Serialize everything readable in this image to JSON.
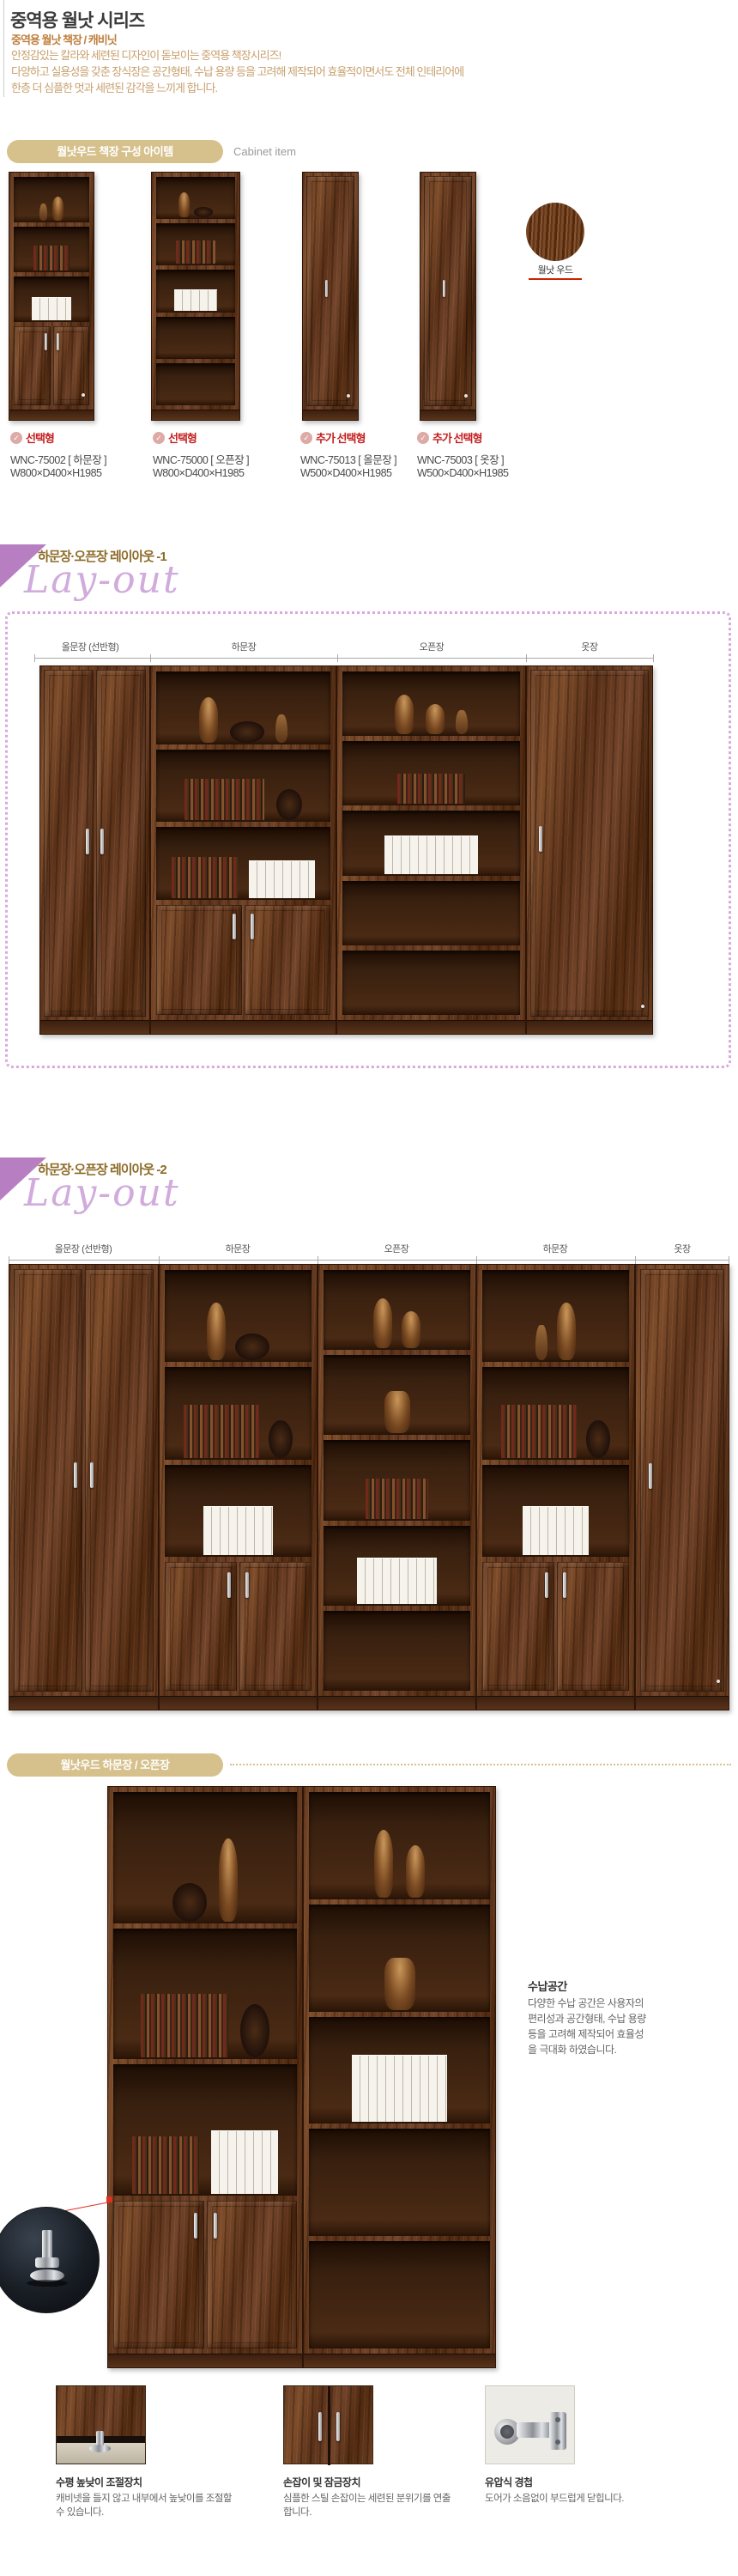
{
  "colors": {
    "accent_tan": "#d6c18c",
    "accent_purple": "#b77fc1",
    "script_purple": "#d0abdc",
    "badge_red": "#c42020",
    "section_title_brown": "#8d6b28",
    "subtitle_orange": "#bf7f3d",
    "desc_tan": "#c8a06e",
    "wood_brown": "#6b3f20",
    "marker_red": "#e03020"
  },
  "header": {
    "title": "중역용 월낫 시리즈",
    "subtitle": "중역용 월낫 책장 / 캐비닛",
    "desc_lines": [
      "안정감있는 칼라와 세련된 디자인이 돋보이는 중역용 책장시리즈!",
      "다양하고 실용성을 갖춘 장식장은 공간형태, 수납 용량 등을 고려해 제작되어 효율적이면서도 전체 인테리어에",
      "한층 더 심플한 멋과 세련된 감각을 느끼게 합니다."
    ]
  },
  "cabinet_items": {
    "banner": "월낫우드 책장 구성 아이템",
    "banner_en": "Cabinet item",
    "wood_swatch_label": "월낫 우드",
    "products": [
      {
        "badge": "선택형",
        "model": "WNC-75002  [ 하문장 ]",
        "size": "W800×D400×H1985"
      },
      {
        "badge": "선택형",
        "model": "WNC-75000  [ 오픈장 ]",
        "size": "W800×D400×H1985"
      },
      {
        "badge": "추가 선택형",
        "model": "WNC-75013  [ 올문장 ]",
        "size": "W500×D400×H1985"
      },
      {
        "badge": "추가 선택형",
        "model": "WNC-75003  [ 옷장 ]",
        "size": "W500×D400×H1985"
      }
    ]
  },
  "layout1": {
    "title": "하문장·오픈장 레이아웃 -1",
    "script_word": "Lay-out",
    "labels": [
      "올문장 (선반형)",
      "하문장",
      "오픈장",
      "옷장"
    ]
  },
  "layout2": {
    "title": "하문장·오픈장 레이아웃 -2",
    "script_word": "Lay-out",
    "labels": [
      "올문장 (선반형)",
      "하문장",
      "오픈장",
      "하문장",
      "옷장"
    ]
  },
  "detail": {
    "banner": "월낫우드 하문장 / 오픈장",
    "storage_title": "수납공간",
    "storage_lines": [
      "다양한 수납 공간은 사용자의",
      "편리성과 공간형태, 수납 용량",
      "등을 고려해 제작되어 효율성",
      "을 극대화 하였습니다."
    ],
    "features": [
      {
        "title": "수평 높낮이 조절장치",
        "desc": "캐비넷을 들지 않고 내부에서 높낮이를 조절할 수 있습니다."
      },
      {
        "title": "손잡이 및 잠금장치",
        "desc": "심플한 스틸 손잡이는 세련된 분위기를 연출합니다."
      },
      {
        "title": "유압식 경첩",
        "desc": "도어가 소음없이 부드럽게 닫힙니다."
      }
    ]
  }
}
